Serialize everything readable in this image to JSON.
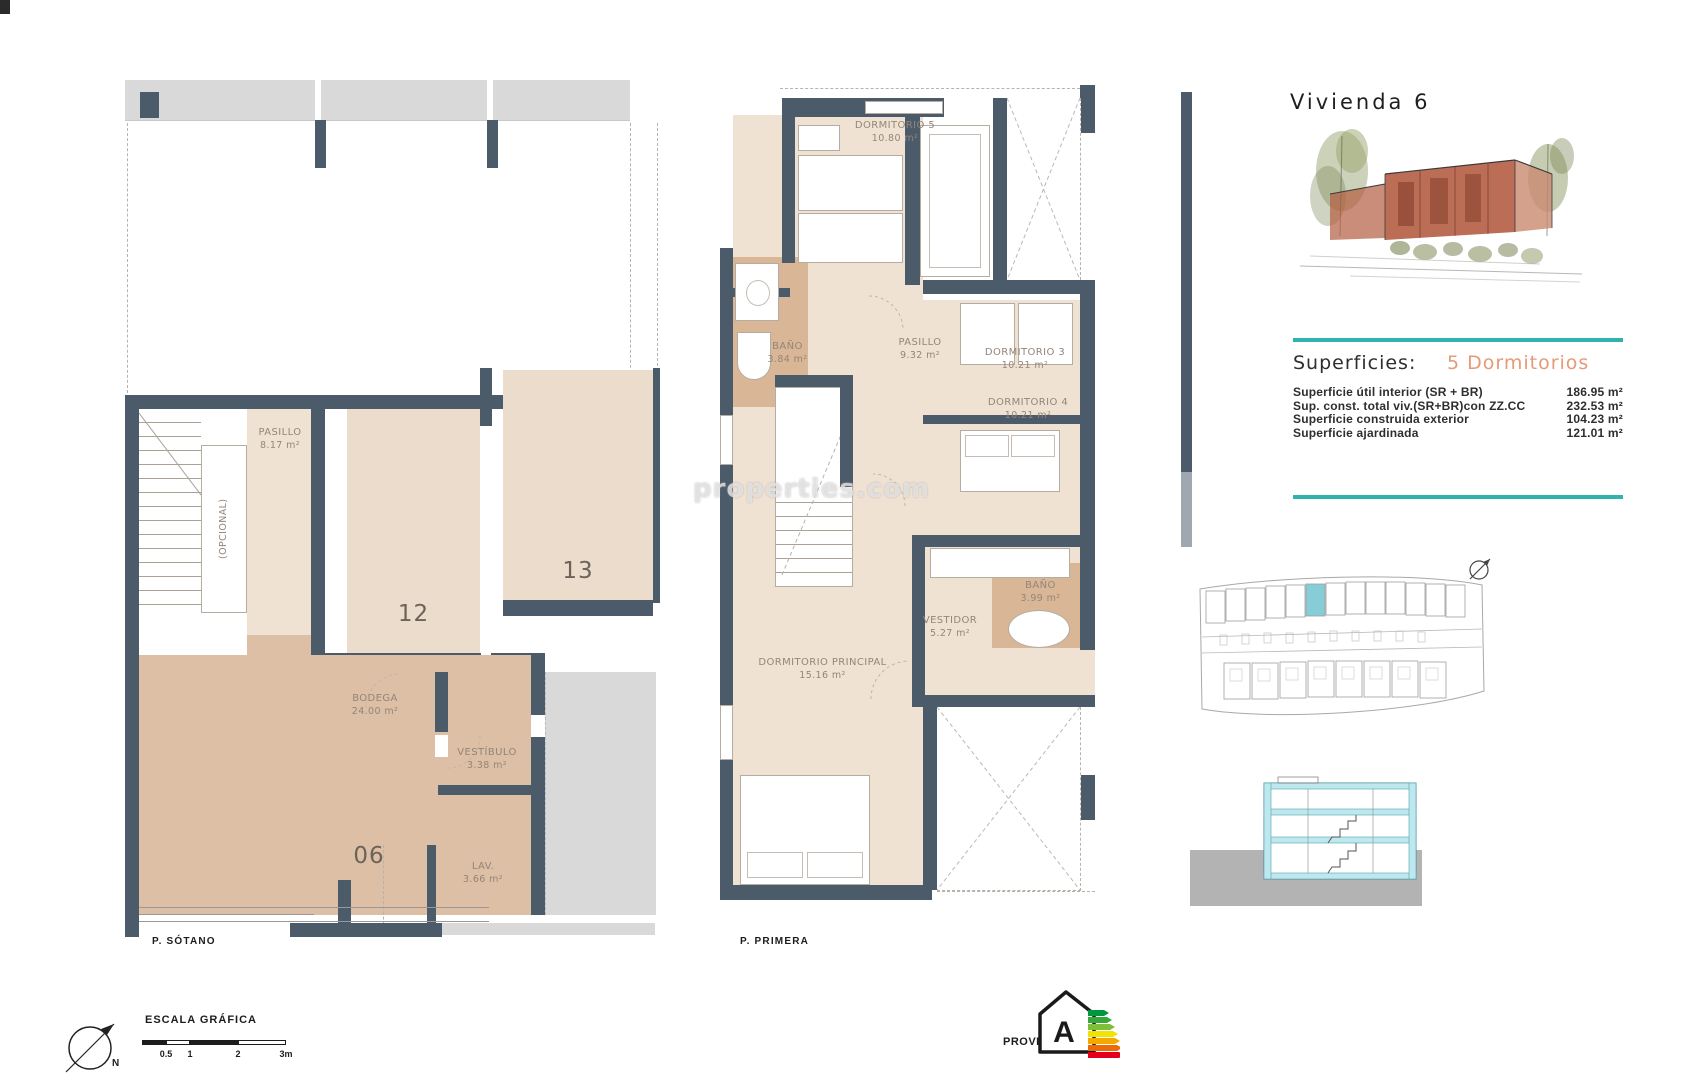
{
  "watermark": "properties.com",
  "panel": {
    "title": "Vivienda 6",
    "superficies_heading": "Superficies:",
    "bedrooms_heading": "5 Dormitorios",
    "surface_rows": [
      {
        "label": "Superficie útil interior (SR + BR)",
        "value": "186.95 m²"
      },
      {
        "label": "Sup. const. total viv.(SR+BR)con ZZ.CC",
        "value": "232.53 m²"
      },
      {
        "label": "Superficie construida exterior",
        "value": "104.23 m²"
      },
      {
        "label": "Superficie ajardinada",
        "value": "121.01 m²"
      }
    ]
  },
  "sotano": {
    "caption": "P. SÓTANO",
    "pasillo": {
      "label": "PASILLO",
      "area": "8.17 m²"
    },
    "opcional": "(OPCIONAL)",
    "parking12": "12",
    "parking13": "13",
    "bodega": {
      "label": "BODEGA",
      "area": "24.00 m²"
    },
    "vestibulo": {
      "label": "VESTÍBULO",
      "area": "3.38 m²"
    },
    "unit06": "06",
    "lav": {
      "label": "LAV.",
      "area": "3.66 m²"
    }
  },
  "primera": {
    "caption": "P. PRIMERA",
    "dorm5": {
      "label": "DORMITORIO 5",
      "area": "10.80 m²"
    },
    "pasillo": {
      "label": "PASILLO",
      "area": "9.32 m²"
    },
    "bano1": {
      "label": "BAÑO",
      "area": "3.84 m²"
    },
    "dorm3": {
      "label": "DORMITORIO 3",
      "area": "10.21 m²"
    },
    "dorm4": {
      "label": "DORMITORIO 4",
      "area": "10.21 m²"
    },
    "bano2": {
      "label": "BAÑO",
      "area": "3.99 m²"
    },
    "vestidor": {
      "label": "VESTIDOR",
      "area": "5.27 m²"
    },
    "principal": {
      "label": "DORMITORIO PRINCIPAL",
      "area": "15.16 m²"
    }
  },
  "footer": {
    "scale_heading": "ESCALA GRÁFICA",
    "scale_ticks": [
      "0.5",
      "1",
      "2",
      "3m"
    ],
    "north_label": "N",
    "provisional_label": "PROVISIONAL",
    "energy_letter": "A"
  },
  "colors": {
    "wall": "#4b5b69",
    "floor_beige": "#f0e2d3",
    "floor_tan": "#dcbfa4",
    "teal_rule": "#2fb3ac",
    "accent_salmon": "#e59a78",
    "site_highlight": "#86cdd8"
  }
}
